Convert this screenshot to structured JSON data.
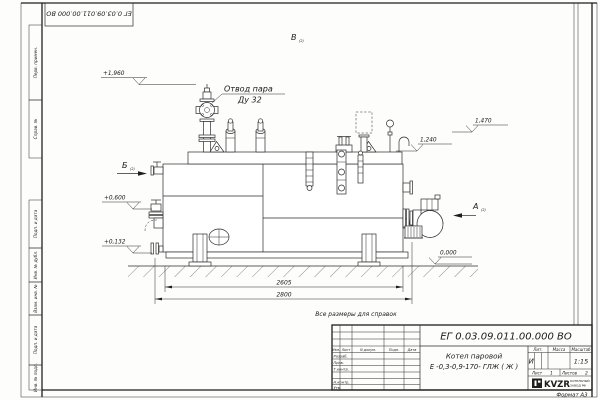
{
  "frame": {
    "top_stamp": "ЕГ 0.03.09.011.00.000  ВО",
    "format_note": "Формат А3",
    "margin_labels": [
      "Перв. примен.",
      "Справ. №",
      "Подп. и дата",
      "Инв. № дубл.",
      "Взам. инв. №",
      "Подп. и дата",
      "Инв. № подл."
    ]
  },
  "drawing": {
    "note": "Все размеры для справок",
    "steam_label_line1": "Отвод пара",
    "steam_label_line2": "Ду 32",
    "views": {
      "a": "А",
      "b": "Б",
      "v": "В",
      "ref": "(2)"
    },
    "elevations": {
      "e1960": "+1,960",
      "e600": "+0,600",
      "e132": "+0,132",
      "e0": "0,000",
      "e1240": "1,240",
      "e1470": "1,470"
    },
    "dimensions": {
      "inner": "2605",
      "outer": "2800"
    }
  },
  "title_block": {
    "designation": "ЕГ 0.03.09.011.00.000  ВО",
    "name_line1": "Котел паровой",
    "name_line2": "Е -0,3-0,9-170- ГЛЖ ( Ж )",
    "headers": {
      "lit": "Лит.",
      "mass": "Масса",
      "scale": "Масштаб"
    },
    "lit_value": "И",
    "scale_value": "1:15",
    "sheet_label": "Лист",
    "sheet_value": "1",
    "sheets_label": "Листов",
    "sheets_value": "2",
    "staff_header": [
      "Изм.",
      "Лист",
      "N докум.",
      "Подп.",
      "Дата"
    ],
    "staff_rows": [
      "Разраб.",
      "Пров.",
      "Т.контр.",
      "Н.контр.",
      "Утв."
    ],
    "logo": {
      "text": "KVZR",
      "sub_line1": "КОТЕЛЬНЫЙ",
      "sub_line2": "ЗАВОД РФ"
    }
  }
}
